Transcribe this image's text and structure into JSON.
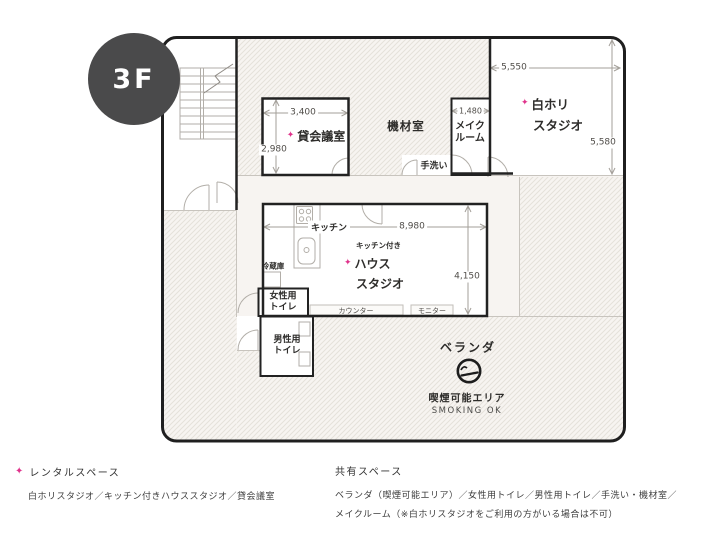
{
  "star": "✦",
  "badge": {
    "label": "3F"
  },
  "colors": {
    "accent_pink": "#e0338c",
    "wall_black": "#222222",
    "badge_bg": "#4a4a4b",
    "plan_cream": "#f7f4f1"
  },
  "plan": {
    "rooms": {
      "meeting": {
        "name": "貸会議室",
        "width": "3,400",
        "height": "2,980"
      },
      "equipment": {
        "name": "機材室"
      },
      "makeup": {
        "name_line1": "メイク",
        "name_line2": "ルーム",
        "width": "1,480"
      },
      "white_studio": {
        "name_line1": "白ホリ",
        "name_line2": "スタジオ",
        "width": "5,550",
        "height": "5,580"
      },
      "house_studio": {
        "prefix": "キッチン付き",
        "name_line1": "ハウス",
        "name_line2": "スタジオ",
        "width": "8,980",
        "height": "4,150"
      },
      "kitchen": {
        "name": "キッチン"
      },
      "fridge": {
        "name": "冷蔵庫"
      },
      "handwash": {
        "name": "手洗い"
      },
      "counter": {
        "name": "カウンター"
      },
      "monitor": {
        "name": "モニター"
      },
      "womens_toilet": {
        "name_line1": "女性用",
        "name_line2": "トイレ"
      },
      "mens_toilet": {
        "name_line1": "男性用",
        "name_line2": "トイレ"
      },
      "veranda": {
        "name": "ベランダ",
        "smoking_label": "喫煙可能エリア",
        "smoking_en": "SMOKING OK"
      }
    }
  },
  "legend": {
    "rental": {
      "title": "レンタルスペース",
      "items": "白ホリスタジオ／キッチン付きハウススタジオ／貸会議室"
    },
    "shared": {
      "title": "共有スペース",
      "items_line1": "ベランダ（喫煙可能エリア）／女性用トイレ／男性用トイレ／手洗い・機材室／",
      "items_line2": "メイクルーム（※白ホリスタジオをご利用の方がいる場合は不可）"
    }
  }
}
